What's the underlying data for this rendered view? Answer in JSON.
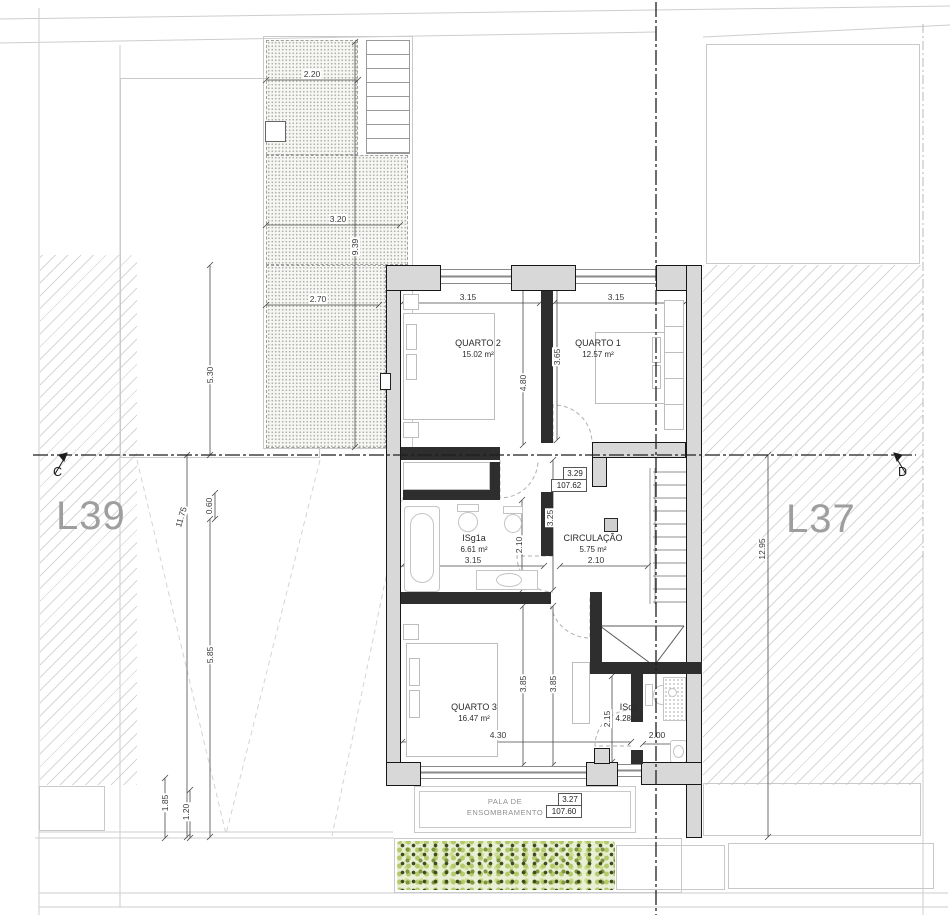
{
  "rooms": {
    "quarto2": {
      "name": "QUARTO 2",
      "area": "15.02 m²"
    },
    "quarto1": {
      "name": "QUARTO 1",
      "area": "12.57 m²"
    },
    "isg1a": {
      "name": "ISg1a",
      "area": "6.61 m²"
    },
    "circulacao": {
      "name": "CIRCULAÇÃO",
      "area": "5.75 m²"
    },
    "quarto3": {
      "name": "QUARTO 3",
      "area": "16.47 m²"
    },
    "isq3": {
      "name": "ISq3",
      "area": "4.28 m²"
    }
  },
  "lots": {
    "left": "L39",
    "right": "L37"
  },
  "sections": {
    "left": "C",
    "right": "D"
  },
  "levels": {
    "upper": {
      "relative": "3.29",
      "absolute": "107.62"
    },
    "lower": {
      "relative": "3.27",
      "absolute": "107.60"
    }
  },
  "canopy": {
    "line1": "PALA DE",
    "line2": "ENSOMBRAMENTO"
  },
  "dimensions": {
    "terrace_top_width": "2.20",
    "terrace_mid_width": "3.20",
    "terrace_height": "9.39",
    "terrace_bottom_width": "2.70",
    "left_upper": "5.30",
    "left_total": "11.75",
    "left_small": "0.60",
    "left_lower": "5.85",
    "plot_left_depth": "1.85",
    "plot_left_inner": "1.20",
    "right_depth": "12.95",
    "q2_width": "3.15",
    "q1_width": "3.15",
    "q2_depth": "4.80",
    "q1_depth": "3.65",
    "hall_depth": "3.25",
    "isg1a_depth": "2.10",
    "isg1a_width": "3.15",
    "circ_width": "2.10",
    "q3_depth_a": "3.85",
    "q3_depth_b": "3.85",
    "isq3_depth": "2.15",
    "q3_width": "4.30",
    "isq3_width": "2.00"
  },
  "palette": {
    "wall_fill": "#d8d8d8",
    "hedge_light": "#b5ca6d",
    "hedge_dark": "#3e4a1e",
    "lot_label_gray": "#9e9e9e"
  }
}
